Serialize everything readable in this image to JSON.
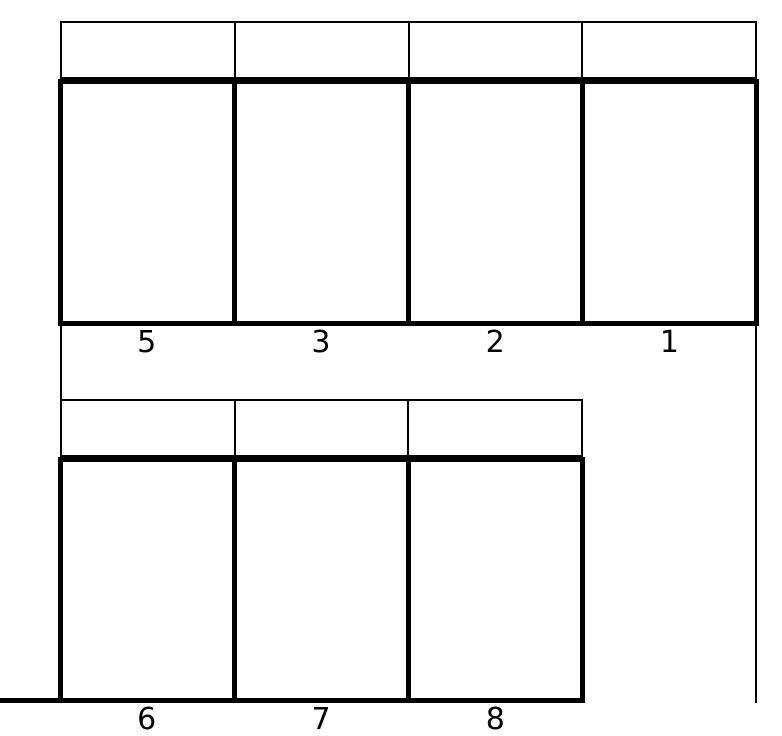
{
  "diagram": {
    "background_color": "#ffffff",
    "line_color": "#000000",
    "rows": [
      {
        "name": "top-row",
        "cells": [
          {
            "label": "5"
          },
          {
            "label": "3"
          },
          {
            "label": "2"
          },
          {
            "label": "1"
          }
        ]
      },
      {
        "name": "bottom-row",
        "cells": [
          {
            "label": "6"
          },
          {
            "label": "7"
          },
          {
            "label": "8"
          }
        ]
      }
    ]
  }
}
